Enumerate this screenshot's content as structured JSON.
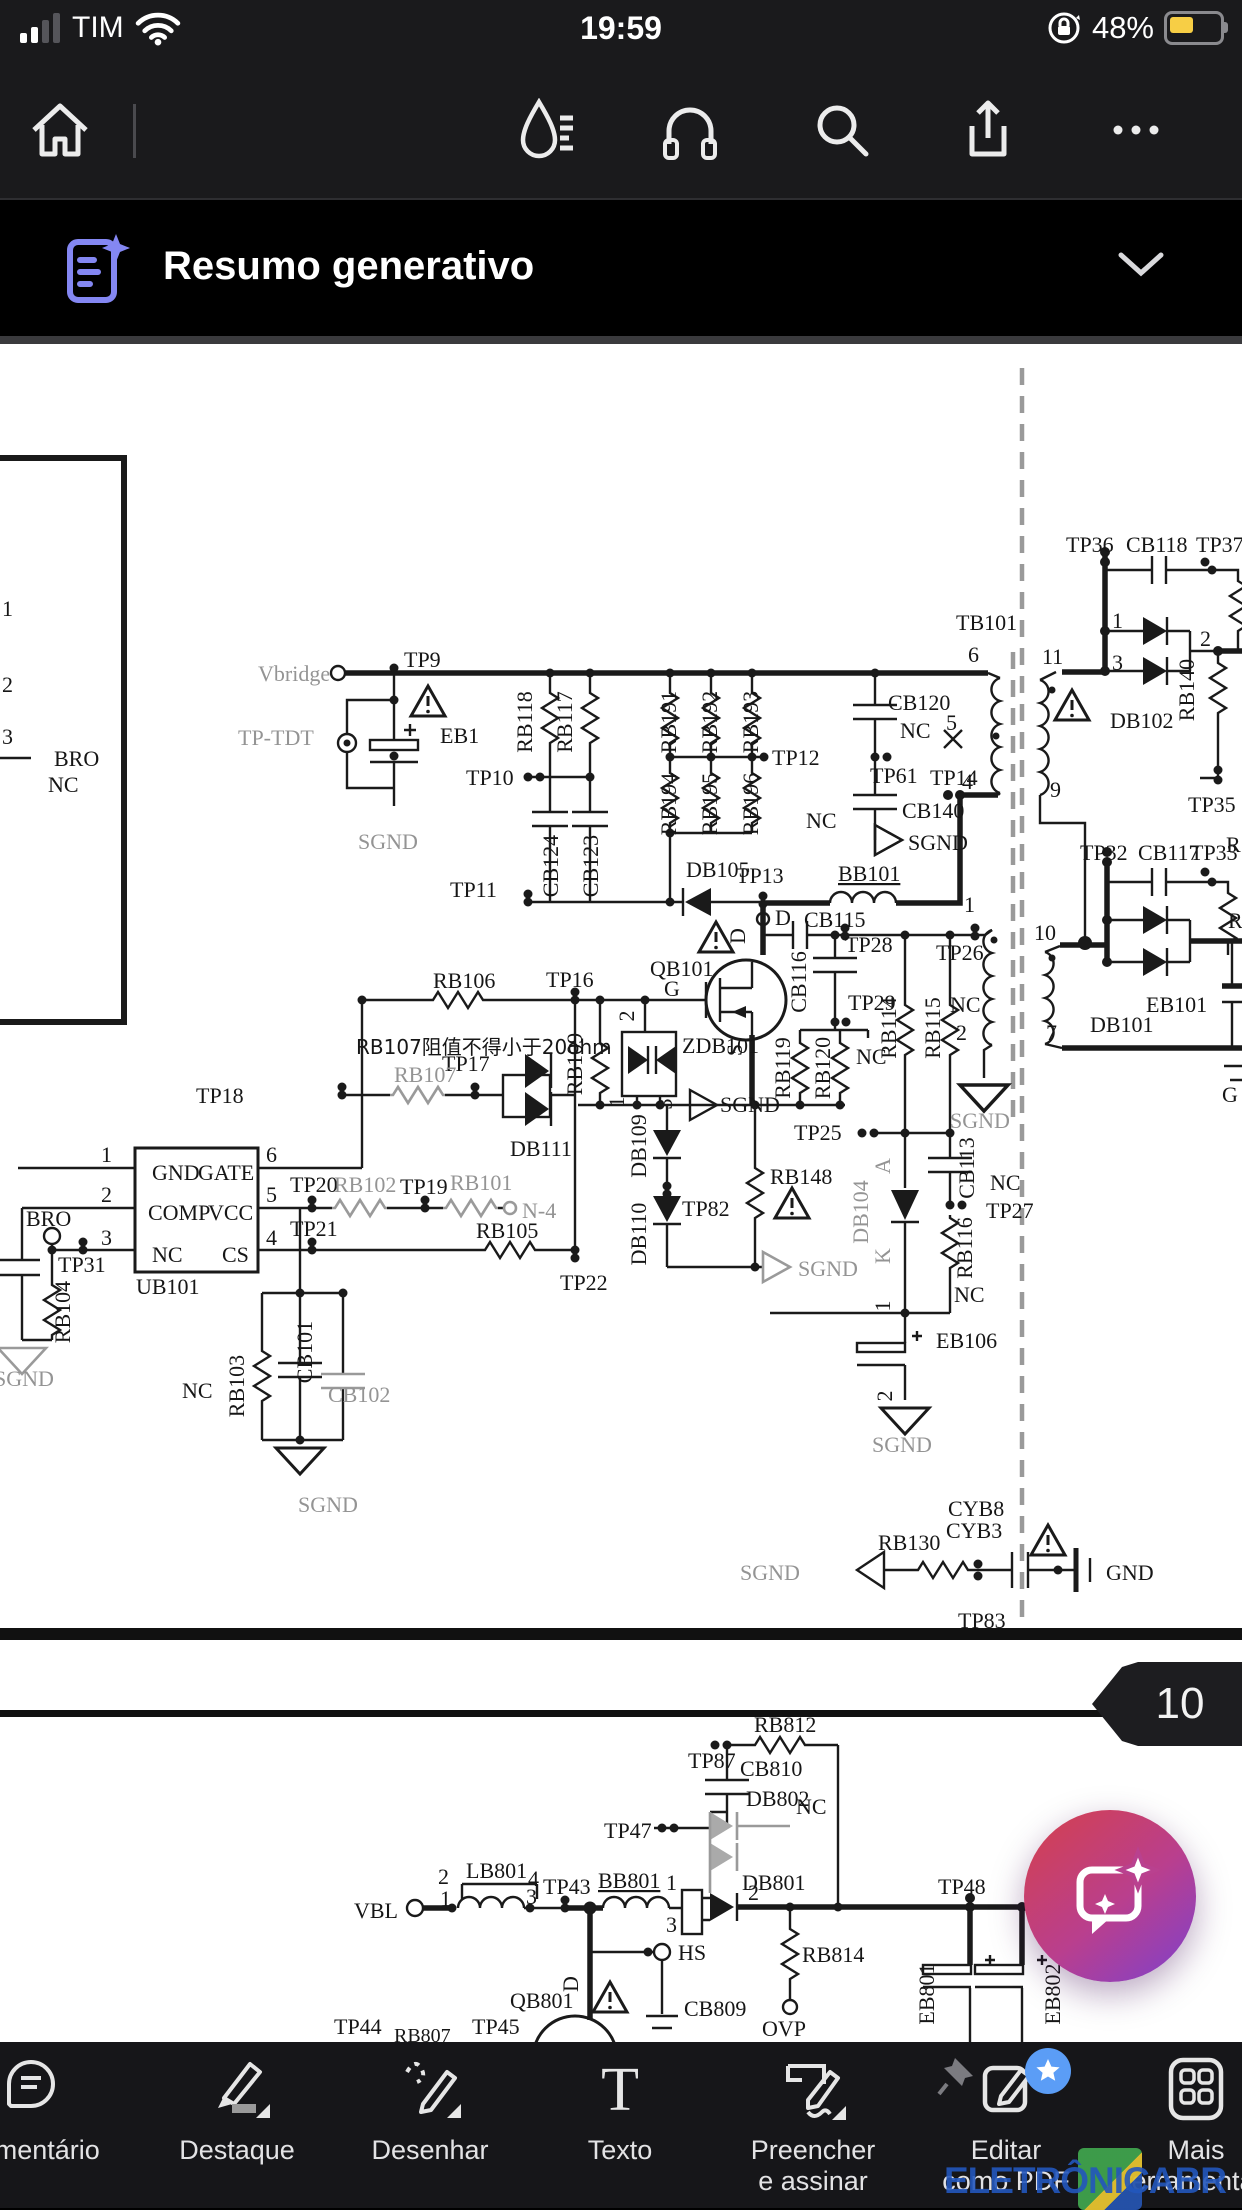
{
  "status_bar": {
    "carrier": "TIM",
    "time": "19:59",
    "battery": "48%",
    "icons": [
      "signal-bars-icon",
      "wifi-icon",
      "rotation-lock-icon",
      "battery-icon"
    ]
  },
  "top_toolbar": {
    "icons": [
      "home-icon",
      "liquid-mode-icon",
      "read-aloud-icon",
      "search-icon",
      "share-icon",
      "more-icon"
    ]
  },
  "banner": {
    "title": "Resumo generativo",
    "icon": "generative-summary-icon",
    "chevron": "chevron-down-icon"
  },
  "pdf": {
    "page_badge": "10"
  },
  "fab": {
    "icon": "ai-chat-sparkle-icon"
  },
  "watermark": {
    "text": "ELETRÔNICABR"
  },
  "bottom_toolbar": {
    "items": [
      {
        "id": "comment",
        "label": "Comentário",
        "line2": ""
      },
      {
        "id": "highlight",
        "label": "Destaque",
        "line2": ""
      },
      {
        "id": "draw",
        "label": "Desenhar",
        "line2": ""
      },
      {
        "id": "text",
        "label": "Texto",
        "line2": ""
      },
      {
        "id": "fill-sign",
        "label": "Preencher",
        "line2": "e assinar"
      },
      {
        "id": "edit-pdf",
        "label": "Editar",
        "line2": "como PDF"
      },
      {
        "id": "more-tools",
        "label": "Mais",
        "line2": "ferramentas"
      }
    ]
  },
  "schematic": {
    "page1": [
      {
        "t": "Vbridge",
        "x": 258,
        "y": 681,
        "c": "g"
      },
      {
        "t": "TP9",
        "x": 404,
        "y": 667
      },
      {
        "t": "TP-TDT",
        "x": 238,
        "y": 745,
        "c": "g"
      },
      {
        "t": "EB1",
        "x": 440,
        "y": 743
      },
      {
        "t": "SGND",
        "x": 358,
        "y": 849,
        "c": "g"
      },
      {
        "t": "RB118",
        "x": 532,
        "y": 722,
        "r": -90,
        "a": "m"
      },
      {
        "t": "RB117",
        "x": 572,
        "y": 722,
        "r": -90,
        "a": "m"
      },
      {
        "t": "TP10",
        "x": 466,
        "y": 785
      },
      {
        "t": "CB124",
        "x": 558,
        "y": 866,
        "r": -90,
        "a": "m"
      },
      {
        "t": "CB123",
        "x": 598,
        "y": 866,
        "r": -90,
        "a": "m"
      },
      {
        "t": "TP11",
        "x": 450,
        "y": 897
      },
      {
        "t": "RB191",
        "x": 676,
        "y": 722,
        "r": -90,
        "a": "m"
      },
      {
        "t": "RB192",
        "x": 717,
        "y": 722,
        "r": -90,
        "a": "m"
      },
      {
        "t": "RB193",
        "x": 758,
        "y": 722,
        "r": -90,
        "a": "m"
      },
      {
        "t": "TP12",
        "x": 772,
        "y": 765
      },
      {
        "t": "RB194",
        "x": 676,
        "y": 804,
        "r": -90,
        "a": "m"
      },
      {
        "t": "RB195",
        "x": 717,
        "y": 804,
        "r": -90,
        "a": "m"
      },
      {
        "t": "RB196",
        "x": 758,
        "y": 804,
        "r": -90,
        "a": "m"
      },
      {
        "t": "CB120",
        "x": 888,
        "y": 710
      },
      {
        "t": "NC",
        "x": 900,
        "y": 738
      },
      {
        "t": "TP61",
        "x": 870,
        "y": 783
      },
      {
        "t": "TP14",
        "x": 930,
        "y": 785
      },
      {
        "t": "NC",
        "x": 806,
        "y": 828
      },
      {
        "t": "CB140",
        "x": 902,
        "y": 818
      },
      {
        "t": "SGND",
        "x": 908,
        "y": 850
      },
      {
        "t": "TB101",
        "x": 956,
        "y": 630
      },
      {
        "t": "6",
        "x": 968,
        "y": 662
      },
      {
        "t": "5",
        "x": 946,
        "y": 730
      },
      {
        "t": "4",
        "x": 962,
        "y": 789
      },
      {
        "t": "1",
        "x": 964,
        "y": 912
      },
      {
        "t": "TP26",
        "x": 936,
        "y": 960
      },
      {
        "t": "NC",
        "x": 950,
        "y": 1012
      },
      {
        "t": "2",
        "x": 956,
        "y": 1040
      },
      {
        "t": "SGND",
        "x": 950,
        "y": 1128,
        "c": "g"
      },
      {
        "t": "DB105",
        "x": 686,
        "y": 877
      },
      {
        "t": "TP13",
        "x": 736,
        "y": 883
      },
      {
        "t": "D",
        "x": 775,
        "y": 925
      },
      {
        "t": "BB101",
        "x": 838,
        "y": 881,
        "u": 1
      },
      {
        "t": "CB115",
        "x": 804,
        "y": 927
      },
      {
        "t": "TP28",
        "x": 845,
        "y": 952
      },
      {
        "t": "D",
        "x": 745,
        "y": 936,
        "r": -90,
        "a": "m"
      },
      {
        "t": "QB101",
        "x": 650,
        "y": 976
      },
      {
        "t": "G",
        "x": 664,
        "y": 996
      },
      {
        "t": "TP16",
        "x": 546,
        "y": 987
      },
      {
        "t": "RB106",
        "x": 433,
        "y": 988
      },
      {
        "t": "RB107阻值不得小于20ohm",
        "x": 356,
        "y": 1054,
        "fs": 20,
        "cn": 1
      },
      {
        "t": "TP17",
        "x": 442,
        "y": 1071
      },
      {
        "t": "RB107",
        "x": 394,
        "y": 1082,
        "c": "g"
      },
      {
        "t": "TP18",
        "x": 196,
        "y": 1103
      },
      {
        "t": "DB111",
        "x": 510,
        "y": 1156
      },
      {
        "t": "RB109",
        "x": 582,
        "y": 1064,
        "r": -90,
        "a": "m"
      },
      {
        "t": "ZDB101",
        "x": 682,
        "y": 1053
      },
      {
        "t": "2",
        "x": 634,
        "y": 1016,
        "r": -90,
        "a": "m"
      },
      {
        "t": "1",
        "x": 624,
        "y": 1102,
        "r": -90,
        "a": "m"
      },
      {
        "t": "3",
        "x": 672,
        "y": 1104,
        "r": -90,
        "a": "m"
      },
      {
        "t": "S",
        "x": 742,
        "y": 1050,
        "r": -90,
        "a": "m"
      },
      {
        "t": "SGND",
        "x": 720,
        "y": 1112
      },
      {
        "t": "CB116",
        "x": 806,
        "y": 982,
        "r": -90,
        "a": "m"
      },
      {
        "t": "TP29",
        "x": 848,
        "y": 1010
      },
      {
        "t": "RB119",
        "x": 790,
        "y": 1068,
        "r": -90,
        "a": "m"
      },
      {
        "t": "RB120",
        "x": 830,
        "y": 1068,
        "r": -90,
        "a": "m"
      },
      {
        "t": "NC",
        "x": 856,
        "y": 1064
      },
      {
        "t": "RB114",
        "x": 896,
        "y": 1028,
        "r": -90,
        "a": "m"
      },
      {
        "t": "RB115",
        "x": 940,
        "y": 1028,
        "r": -90,
        "a": "m"
      },
      {
        "t": "TP25",
        "x": 794,
        "y": 1140
      },
      {
        "t": "DB109",
        "x": 646,
        "y": 1146,
        "r": -90,
        "a": "m"
      },
      {
        "t": "TP82",
        "x": 682,
        "y": 1216
      },
      {
        "t": "DB110",
        "x": 646,
        "y": 1234,
        "r": -90,
        "a": "m"
      },
      {
        "t": "RB148",
        "x": 770,
        "y": 1184
      },
      {
        "t": "SGND",
        "x": 798,
        "y": 1276,
        "c": "g"
      },
      {
        "t": "A",
        "x": 890,
        "y": 1166,
        "r": -90,
        "a": "m",
        "c": "g"
      },
      {
        "t": "DB104",
        "x": 868,
        "y": 1212,
        "r": -90,
        "a": "m",
        "c": "g"
      },
      {
        "t": "K",
        "x": 890,
        "y": 1256,
        "r": -90,
        "a": "m",
        "c": "g"
      },
      {
        "t": "CB113",
        "x": 974,
        "y": 1168,
        "r": -90,
        "a": "m"
      },
      {
        "t": "NC",
        "x": 990,
        "y": 1190
      },
      {
        "t": "TP27",
        "x": 986,
        "y": 1218
      },
      {
        "t": "RB116",
        "x": 972,
        "y": 1248,
        "r": -90,
        "a": "m"
      },
      {
        "t": "NC",
        "x": 954,
        "y": 1302
      },
      {
        "t": "1",
        "x": 890,
        "y": 1306,
        "r": -90,
        "a": "m"
      },
      {
        "t": "EB106",
        "x": 936,
        "y": 1348
      },
      {
        "t": "2",
        "x": 892,
        "y": 1396,
        "r": -90,
        "a": "m"
      },
      {
        "t": "SGND",
        "x": 872,
        "y": 1452,
        "c": "g"
      },
      {
        "t": "TP36",
        "x": 1066,
        "y": 552
      },
      {
        "t": "CB118",
        "x": 1126,
        "y": 552
      },
      {
        "t": "TP37",
        "x": 1196,
        "y": 552
      },
      {
        "t": "1",
        "x": 1112,
        "y": 628
      },
      {
        "t": "3",
        "x": 1112,
        "y": 670
      },
      {
        "t": "11",
        "x": 1042,
        "y": 664
      },
      {
        "t": "2",
        "x": 1200,
        "y": 646
      },
      {
        "t": "DB102",
        "x": 1110,
        "y": 728
      },
      {
        "t": "RB140",
        "x": 1194,
        "y": 690,
        "r": -90,
        "a": "m"
      },
      {
        "t": "9",
        "x": 1050,
        "y": 797
      },
      {
        "t": "TP35",
        "x": 1188,
        "y": 812
      },
      {
        "t": "TP32",
        "x": 1080,
        "y": 860
      },
      {
        "t": "CB117",
        "x": 1138,
        "y": 860
      },
      {
        "t": "TP33",
        "x": 1190,
        "y": 860
      },
      {
        "t": "R",
        "x": 1226,
        "y": 852
      },
      {
        "t": "R",
        "x": 1228,
        "y": 928
      },
      {
        "t": "10",
        "x": 1034,
        "y": 940
      },
      {
        "t": "DB101",
        "x": 1090,
        "y": 1032
      },
      {
        "t": "EB101",
        "x": 1146,
        "y": 1012
      },
      {
        "t": "7",
        "x": 1046,
        "y": 1040
      },
      {
        "t": "G",
        "x": 1222,
        "y": 1102
      },
      {
        "t": "GND",
        "x": 152,
        "y": 1180
      },
      {
        "t": "GATE",
        "x": 198,
        "y": 1180
      },
      {
        "t": "COMP",
        "x": 148,
        "y": 1220
      },
      {
        "t": "VCC",
        "x": 208,
        "y": 1220
      },
      {
        "t": "NC",
        "x": 152,
        "y": 1262
      },
      {
        "t": "CS",
        "x": 222,
        "y": 1262
      },
      {
        "t": "UB101",
        "x": 136,
        "y": 1294
      },
      {
        "t": "1",
        "x": 112,
        "y": 1162,
        "a": "e"
      },
      {
        "t": "2",
        "x": 112,
        "y": 1202,
        "a": "e"
      },
      {
        "t": "3",
        "x": 112,
        "y": 1245,
        "a": "e"
      },
      {
        "t": "6",
        "x": 266,
        "y": 1162
      },
      {
        "t": "5",
        "x": 266,
        "y": 1202
      },
      {
        "t": "4",
        "x": 266,
        "y": 1245
      },
      {
        "t": "TP20",
        "x": 290,
        "y": 1192
      },
      {
        "t": "RB102",
        "x": 334,
        "y": 1192,
        "c": "g"
      },
      {
        "t": "TP19",
        "x": 400,
        "y": 1194
      },
      {
        "t": "RB101",
        "x": 450,
        "y": 1190,
        "c": "g"
      },
      {
        "t": "N-4",
        "x": 522,
        "y": 1218,
        "c": "g"
      },
      {
        "t": "TP21",
        "x": 290,
        "y": 1236
      },
      {
        "t": "RB105",
        "x": 476,
        "y": 1238
      },
      {
        "t": "TP22",
        "x": 560,
        "y": 1290
      },
      {
        "t": "BRO",
        "x": 26,
        "y": 1226
      },
      {
        "t": "TP31",
        "x": 58,
        "y": 1272
      },
      {
        "t": "RB104",
        "x": 70,
        "y": 1312,
        "r": -90,
        "a": "m"
      },
      {
        "t": "RB103",
        "x": 244,
        "y": 1386,
        "r": -90,
        "a": "m"
      },
      {
        "t": "NC",
        "x": 182,
        "y": 1398
      },
      {
        "t": "CB101",
        "x": 312,
        "y": 1352,
        "r": -90,
        "a": "m"
      },
      {
        "t": "CB102",
        "x": 328,
        "y": 1402,
        "c": "g"
      },
      {
        "t": "SGND",
        "x": 298,
        "y": 1512,
        "c": "g"
      },
      {
        "t": "SGND",
        "x": -6,
        "y": 1386,
        "c": "g"
      },
      {
        "t": "CYB8",
        "x": 948,
        "y": 1516
      },
      {
        "t": "CYB3",
        "x": 946,
        "y": 1538
      },
      {
        "t": "RB130",
        "x": 878,
        "y": 1550
      },
      {
        "t": "SGND",
        "x": 740,
        "y": 1580,
        "c": "g"
      },
      {
        "t": "GND",
        "x": 1106,
        "y": 1580
      },
      {
        "t": "TP83",
        "x": 958,
        "y": 1628
      },
      {
        "t": "1",
        "x": 2,
        "y": 616
      },
      {
        "t": "2",
        "x": 2,
        "y": 692
      },
      {
        "t": "3",
        "x": 2,
        "y": 744
      },
      {
        "t": "BRO",
        "x": 54,
        "y": 766
      },
      {
        "t": "NC",
        "x": 48,
        "y": 792
      }
    ],
    "page2": [
      {
        "t": "RB812",
        "x": 754,
        "y": 1732
      },
      {
        "t": "TP87",
        "x": 688,
        "y": 1768
      },
      {
        "t": "CB810",
        "x": 740,
        "y": 1776
      },
      {
        "t": "DB802",
        "x": 746,
        "y": 1806
      },
      {
        "t": "NC",
        "x": 796,
        "y": 1814
      },
      {
        "t": "TP47",
        "x": 604,
        "y": 1838
      },
      {
        "t": "1",
        "x": 666,
        "y": 1890
      },
      {
        "t": "DB801",
        "x": 742,
        "y": 1890
      },
      {
        "t": "3",
        "x": 666,
        "y": 1932
      },
      {
        "t": "2",
        "x": 748,
        "y": 1900
      },
      {
        "t": "VBL",
        "x": 354,
        "y": 1918
      },
      {
        "t": "2",
        "x": 438,
        "y": 1884
      },
      {
        "t": "LB801",
        "x": 466,
        "y": 1878
      },
      {
        "t": "4",
        "x": 528,
        "y": 1886
      },
      {
        "t": "1",
        "x": 440,
        "y": 1906
      },
      {
        "t": "3",
        "x": 526,
        "y": 1904
      },
      {
        "t": "TP43",
        "x": 543,
        "y": 1894
      },
      {
        "t": "BB801",
        "x": 598,
        "y": 1888,
        "u": 1
      },
      {
        "t": "HS",
        "x": 678,
        "y": 1960
      },
      {
        "t": "QB801",
        "x": 510,
        "y": 2008
      },
      {
        "t": "D",
        "x": 578,
        "y": 1984,
        "r": -90,
        "a": "m"
      },
      {
        "t": "CB809",
        "x": 684,
        "y": 2016
      },
      {
        "t": "RB814",
        "x": 802,
        "y": 1962
      },
      {
        "t": "OVP",
        "x": 762,
        "y": 2036
      },
      {
        "t": "TP48",
        "x": 938,
        "y": 1894
      },
      {
        "t": "EB801",
        "x": 934,
        "y": 1994,
        "r": -90,
        "a": "m"
      },
      {
        "t": "EB802",
        "x": 1060,
        "y": 1994,
        "r": -90,
        "a": "m"
      },
      {
        "t": "TP44",
        "x": 334,
        "y": 2034
      },
      {
        "t": "TP45",
        "x": 472,
        "y": 2034
      },
      {
        "t": "RB807",
        "x": 394,
        "y": 2042,
        "fs": 20
      }
    ]
  }
}
